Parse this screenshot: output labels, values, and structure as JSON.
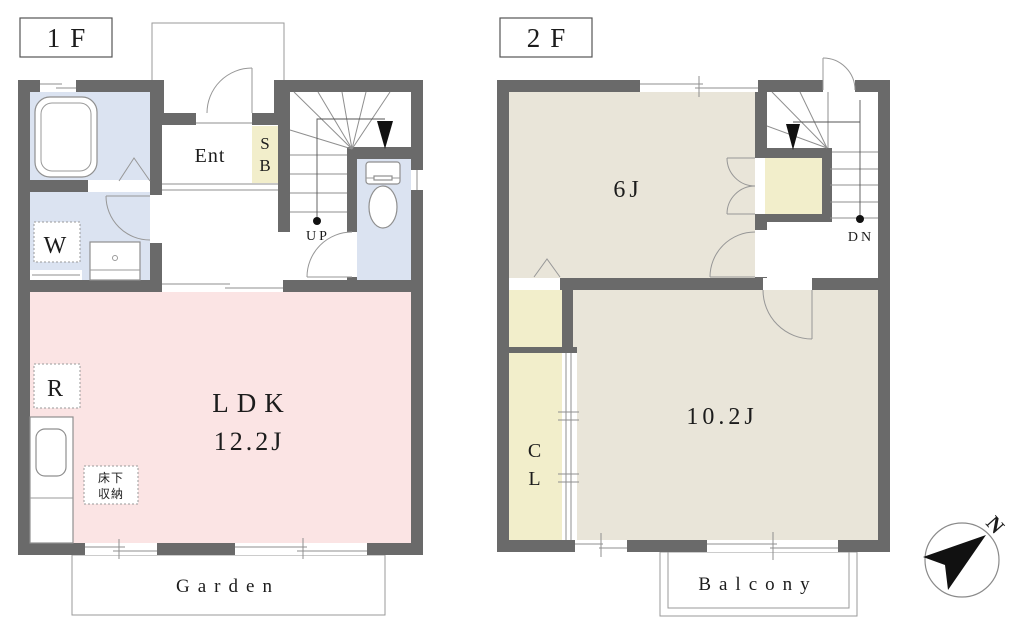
{
  "floor1": {
    "label": "1F",
    "ldk": {
      "name": "LDK",
      "size": "12.2J"
    },
    "entrance": "Ent",
    "shoe_box": {
      "line1": "S",
      "line2": "B"
    },
    "washer": "W",
    "refrigerator": "R",
    "underfloor_storage": {
      "line1": "床下",
      "line2": "収納"
    },
    "stairs_direction": "UP",
    "garden": "Garden"
  },
  "floor2": {
    "label": "2F",
    "room_6j": "6J",
    "room_10_2j": "10.2J",
    "closet": {
      "line1": "C",
      "line2": "L"
    },
    "stairs_direction": "DN",
    "balcony": "Balcony"
  },
  "compass": {
    "north": "N"
  },
  "colors": {
    "wall": "#6a6a6a",
    "water_rooms": "#dbe3f1",
    "ldk": "#fbe4e4",
    "bedrooms": "#e9e5d9",
    "storage": "#f2eecb"
  }
}
